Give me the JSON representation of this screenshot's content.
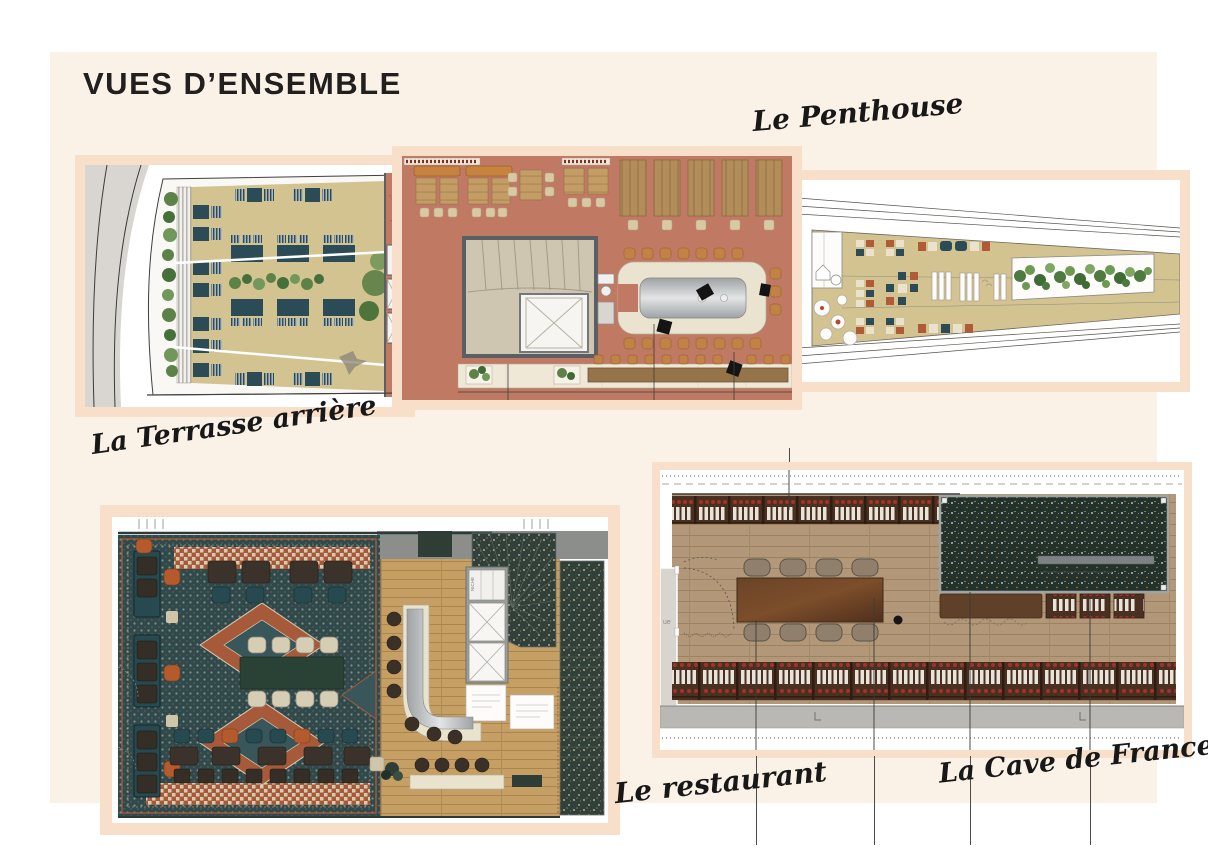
{
  "slide": {
    "title": "VUES D’ENSEMBLE"
  },
  "labels": {
    "penthouse": "Le Penthouse",
    "terrasse": "La Terrasse arrière",
    "restaurant": "Le restaurant",
    "cave": "La Cave de Francette"
  },
  "plans": {
    "terrasse": {
      "caption": "La Terrasse arrière",
      "type": "floor-plan"
    },
    "penthouse": {
      "caption": "Le Penthouse",
      "type": "floor-plan"
    },
    "deck": {
      "caption": "Le Penthouse",
      "type": "roof-deck-plan"
    },
    "restaurant": {
      "caption": "Le restaurant",
      "type": "floor-plan"
    },
    "cave": {
      "caption": "La Cave de Francette",
      "type": "floor-plan"
    }
  },
  "annotations": {
    "niche": "NICHE",
    "cave_door": "ue"
  },
  "colors": {
    "page-bg": "#ffffff",
    "panel-bg": "#faf2e7",
    "frame": "#f8dfca",
    "ink": "#21201e",
    "road": "#d9d6d1",
    "deck-beige": "#d3c391",
    "teal": "#2b4b57",
    "terracotta": "#c07a63",
    "cream": "#eae3cf",
    "orange": "#c5833f",
    "rust": "#b05a38",
    "rug": "#2f4a4d",
    "gray-wall": "#8b8e8b",
    "terrazzo": "#2e3e36",
    "plant-green": "#5d8248",
    "bottle-red": "#a5312a",
    "cave-wood": "#b29878",
    "rack-brown": "#4a3020",
    "metal": "#b9bcbd",
    "sidewalk": "#b9b8b4"
  }
}
